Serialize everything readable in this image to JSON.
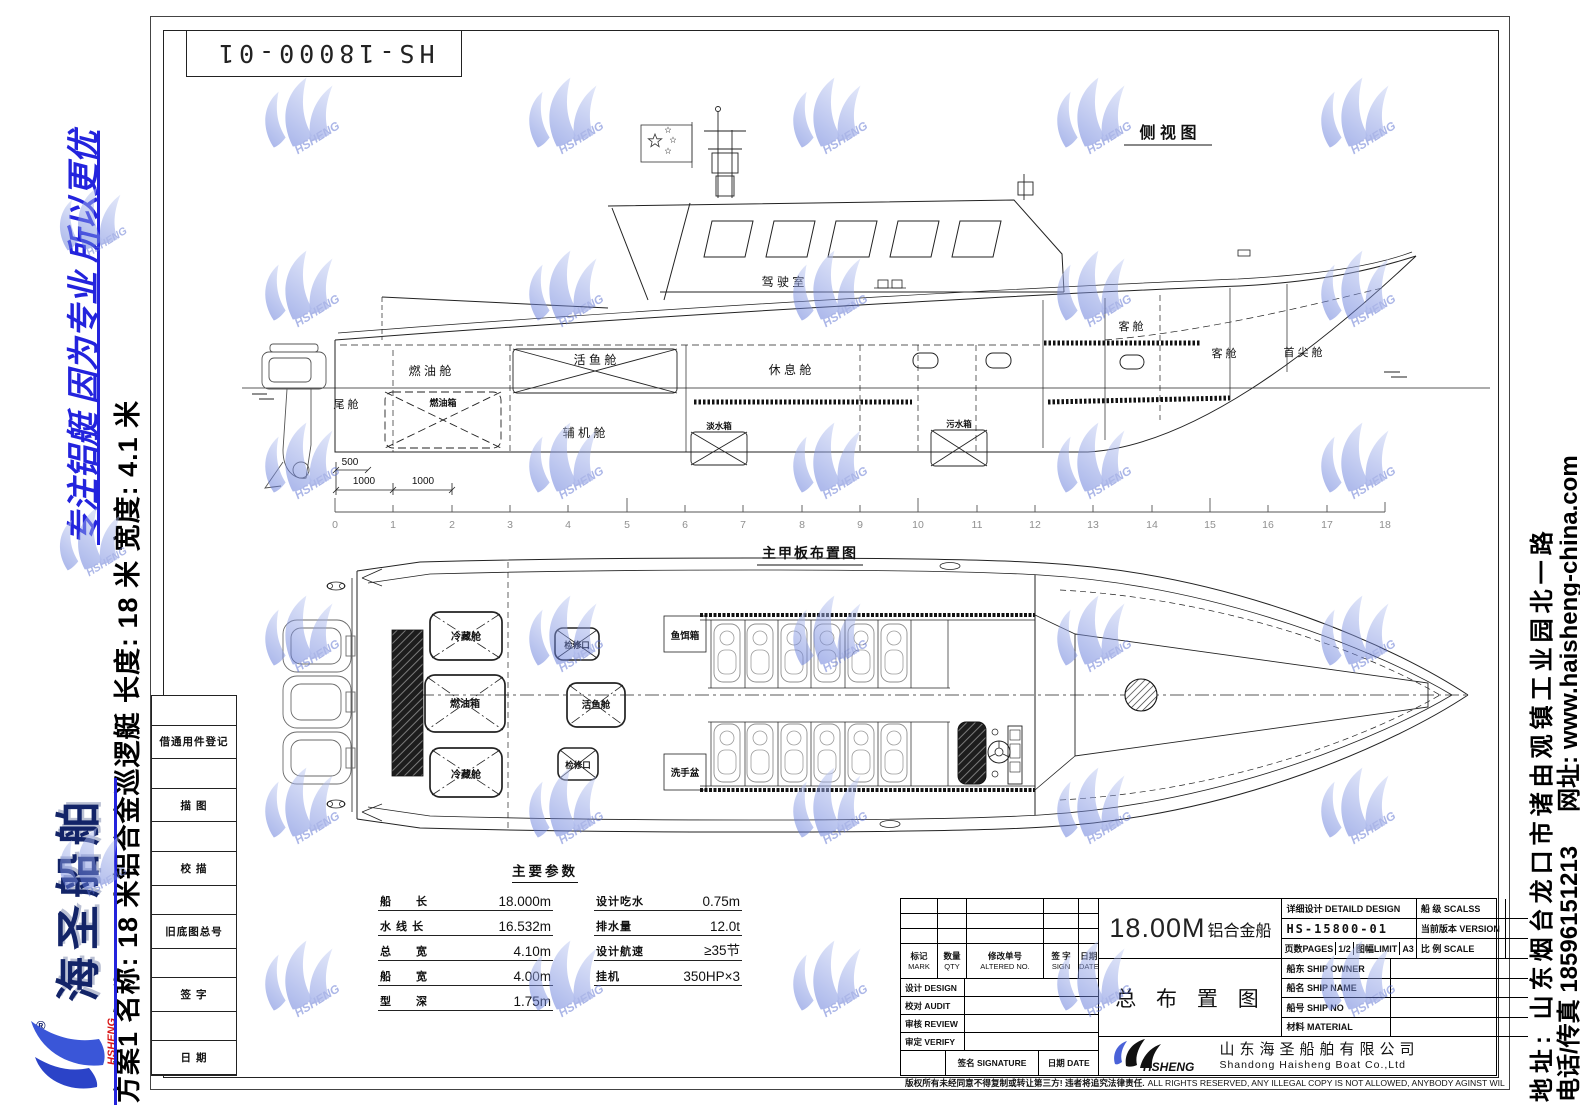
{
  "sheet": {
    "drawing_no_box": "HS-18000-01",
    "copyright_cn": "版权所有未经同意不得复制或转让第三方! 违者将追究法律责任.",
    "copyright_en": "ALL RIGHTS RESERVED, ANY ILLEGAL COPY IS NOT ALLOWED, ANYBODY AGINST WILL BE PROSECUTED."
  },
  "left_sidebar": {
    "slogan": "专注铝艇 因为专业 所以更优",
    "plan_info": "方案1 名称: 18 米铝合金巡逻艇 长度: 18 米 宽度: 4.1 米",
    "logo_text": "海圣船舶",
    "brand": "HSHENG",
    "registered": "®"
  },
  "right_sidebar": {
    "address": "地址: 山东烟台龙口市诸由观镇工业园北一路",
    "phone": "电话/传真 18596151213",
    "website": "网址: www.haisheng-china.com"
  },
  "margin_block": {
    "rows": [
      "借通用件登记",
      "描 图",
      "校 描",
      "旧底图总号",
      "签 字",
      "日 期"
    ]
  },
  "side_view": {
    "title": "侧 视 图",
    "labels": {
      "tail": "尾 舱",
      "fuel_comp": "燃 油 舱",
      "fuel_tank": "燃油箱",
      "live_fish": "活 鱼 舱",
      "aux_engine": "辅 机 舱",
      "rest": "休 息 舱",
      "fresh_water": "淡水箱",
      "sewage": "污水箱",
      "wheelhouse": "驾 驶 室",
      "cabin_a": "客 舱",
      "cabin_b": "客 舱",
      "forepeak": "首 尖 舱"
    },
    "dims": {
      "d500": "500",
      "d1000a": "1000",
      "d1000b": "1000"
    }
  },
  "ruler": {
    "ticks": [
      "0",
      "1",
      "2",
      "3",
      "4",
      "5",
      "6",
      "7",
      "8",
      "9",
      "10",
      "11",
      "12",
      "13",
      "14",
      "15",
      "16",
      "17",
      "18"
    ]
  },
  "deck_plan": {
    "title": "主甲板布置图",
    "labels": {
      "cold_a": "冷藏舱",
      "fuel_tank": "燃油箱",
      "cold_b": "冷藏舱",
      "hatch_a": "检修口",
      "live_fish": "活鱼舱",
      "hatch_b": "检修口",
      "bait": "鱼饵箱",
      "basin": "洗手盆"
    }
  },
  "parameters": {
    "title": "主要参数",
    "left": [
      {
        "label": "船　　长",
        "value": "18.000m"
      },
      {
        "label": "水 线 长",
        "value": "16.532m"
      },
      {
        "label": "总　　宽",
        "value": "4.10m"
      },
      {
        "label": "船　　宽",
        "value": "4.00m"
      },
      {
        "label": "型　　深",
        "value": "1.75m"
      }
    ],
    "right": [
      {
        "label": "设计吃水",
        "value": "0.75m"
      },
      {
        "label": "排水量",
        "value": "12.0t"
      },
      {
        "label": "设计航速",
        "value": "≥35节"
      },
      {
        "label": "挂机",
        "value": "350HP×3"
      }
    ]
  },
  "title_block": {
    "product_num": "18.00M",
    "product_cn": "铝合金船",
    "drawing_title": "总 布 置 图",
    "header": {
      "mark_cn": "标记",
      "mark_en": "MARK",
      "qty_cn": "数量",
      "qty_en": "QTY",
      "altered_cn": "修改单号",
      "altered_en": "ALTERED NO.",
      "sign_cn": "签 字",
      "sign_en": "SIGN",
      "date_cn": "日期",
      "date_en": "DATE"
    },
    "rows": {
      "design": "设计 DESIGN",
      "audit": "校对 AUDIT",
      "review": "审核 REVIEW",
      "verify": "审定 VERIFY"
    },
    "signature": "签名 SIGNATURE",
    "signature_date": "日期 DATE",
    "detail_design": "详细设计  DETAILD DESIGN",
    "class_label": "船 级 SCALSS",
    "drawing_no": "HS-15800-01",
    "version_label": "当前版本 VERSION",
    "pages_label": "页数PAGES",
    "pages_value": "1/2",
    "limit_label": "图幅LIMIT",
    "limit_value": "A3",
    "scale_label": "比 例 SCALE",
    "owner_label": "船东 SHIP OWNER",
    "ship_name_label": "船名 SHIP NAME",
    "ship_no_label": "船号 SHIP NO",
    "material_label": "材料 MATERIAL",
    "brand": "HSHENG",
    "company_cn": "山东海圣船舶有限公司",
    "company_en": "Shandong  Haisheng  Boat Co.,Ltd"
  },
  "watermark": {
    "brand": "HSHENG"
  }
}
